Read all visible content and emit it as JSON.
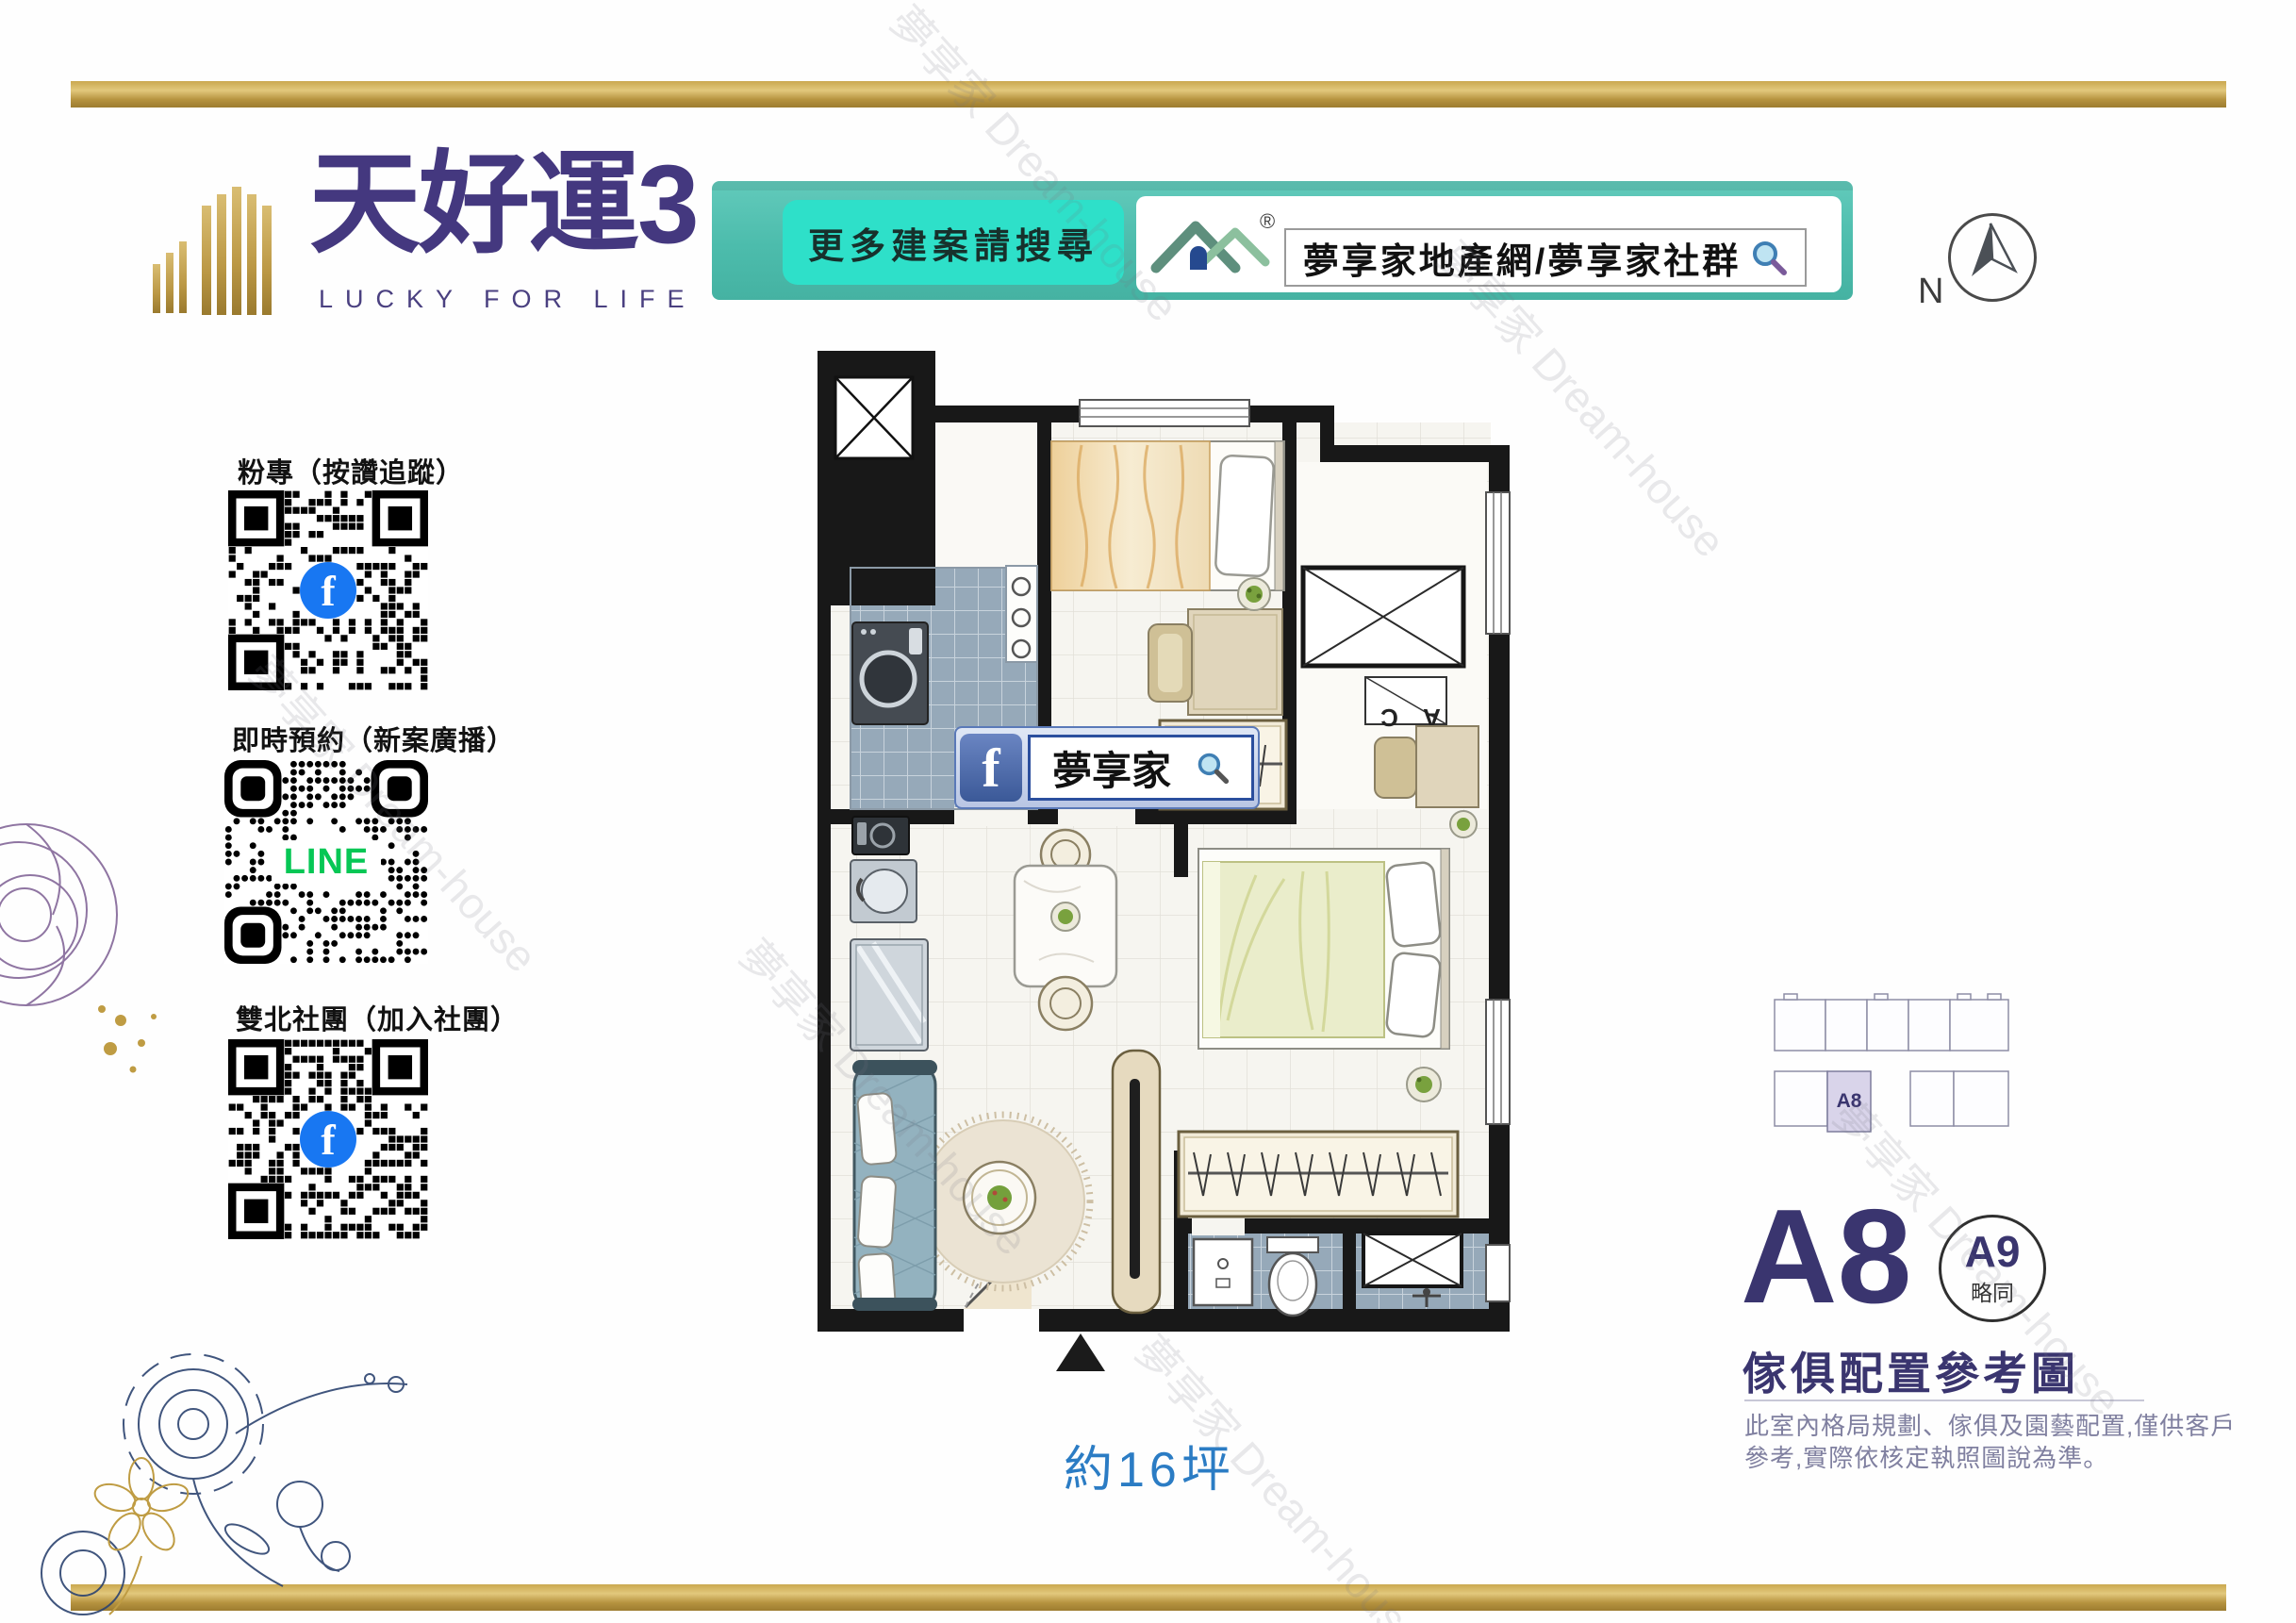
{
  "watermark": {
    "text": "夢享家 Dream-house"
  },
  "header": {
    "logo": {
      "title": "天好運3",
      "subtitle": "LUCKY FOR LIFE"
    },
    "banner": {
      "prompt": "更多建案請搜尋",
      "registered": "®",
      "search_value": "夢享家地產網/夢享家社群"
    },
    "compass": {
      "label": "N"
    }
  },
  "qr_sections": [
    {
      "title": "粉專（按讚追蹤）",
      "center": "f"
    },
    {
      "title": "即時預約（新案廣播）",
      "center": "LINE"
    },
    {
      "title": "雙北社團（加入社團）",
      "center": "f"
    }
  ],
  "floor_plan": {
    "fb_search": {
      "icon_letter": "f",
      "value": "夢享家"
    },
    "ac_label": "A C",
    "area_note": "約16坪"
  },
  "unit_panel": {
    "key_plan_unit": "A8",
    "unit_code": "A8",
    "similar_code": "A9",
    "similar_note": "略同",
    "caption": "傢俱配置參考圖",
    "disclaimer": [
      "此室內格局規劃、傢俱及園藝配置,僅供客戶",
      "參考,實際依核定執照圖說為準。"
    ]
  },
  "colors": {
    "gold": "#c2a04e",
    "teal_banner": "#4cbcac",
    "teal_button": "#2ee0c9",
    "logo_purple": "#44387f",
    "navy": "#3a356f",
    "area_blue": "#2b7cc4",
    "fb_blue": "#1877f2",
    "line_green": "#06c755"
  }
}
